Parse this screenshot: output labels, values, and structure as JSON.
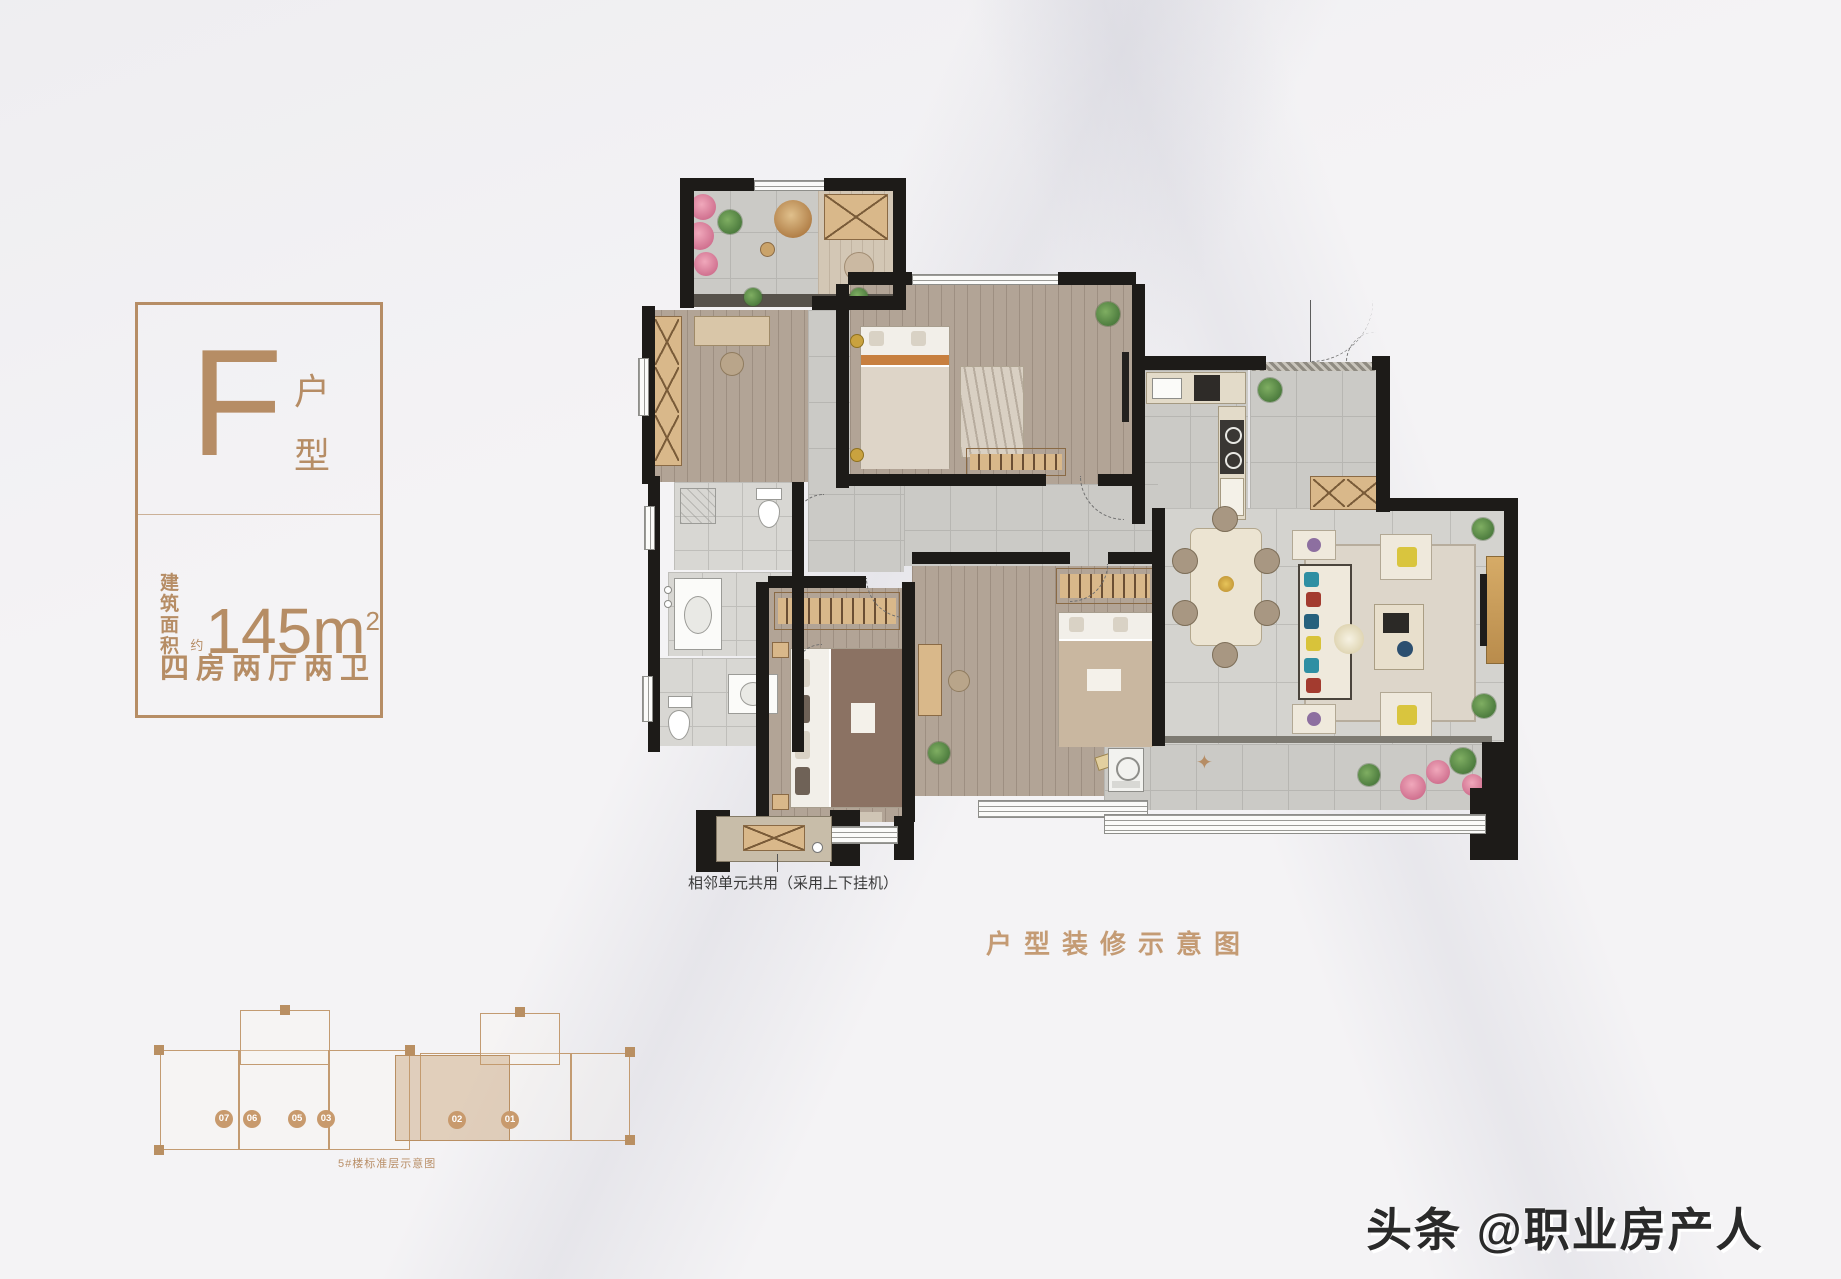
{
  "colors": {
    "accent": "#b68d65",
    "caption": "#c49b74",
    "wall": "#1d1b18",
    "watermark": "#2a2a2a"
  },
  "badge": {
    "unit_letter": "F",
    "unit_type_top": "户",
    "unit_type_bottom": "型",
    "area_label_line1": "建筑",
    "area_label_line2": "面积",
    "area_approx": "约",
    "area_value": "145",
    "area_unit": "m",
    "area_power": "2",
    "layout": "四房两厅两卫"
  },
  "floor_plan": {
    "caption": "户型装修示意图",
    "ac_note": "相邻单元共用（采用上下挂机）",
    "compass_star": "✦"
  },
  "key_plan": {
    "caption": "5#楼标准层示意图",
    "units": [
      "07",
      "06",
      "05",
      "03",
      "02",
      "01"
    ],
    "highlighted_unit": "02"
  },
  "watermark": {
    "text": "头条 @职业房产人"
  }
}
